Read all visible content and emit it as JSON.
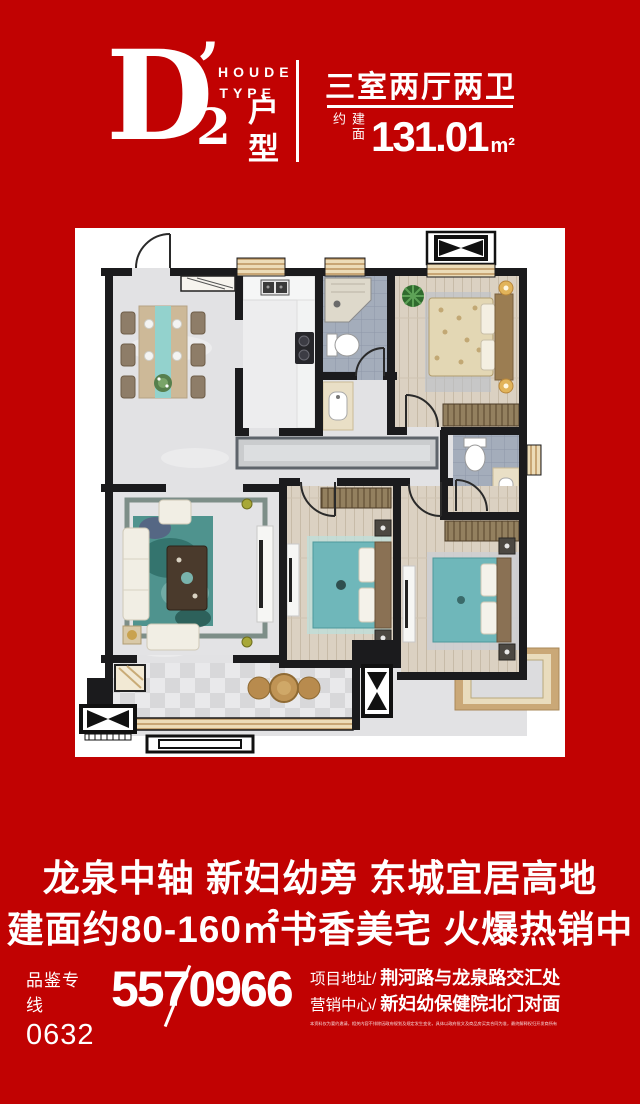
{
  "colors": {
    "background": "#c10202",
    "panel": "#ffffff",
    "text": "#ffffff",
    "wall": "#1b1b1d",
    "teal_furniture": "#6fb7ba",
    "wood_floor": "#dbd1c2",
    "tile_floor": "#a4adbb"
  },
  "header": {
    "type_letter": "D",
    "type_apostrophe": "’",
    "type_number": "2",
    "brand_line1": "HOUDE",
    "brand_line2": "TYPE",
    "type_label": "户型",
    "layout": "三室两厅两卫",
    "area_prefix": "建面约",
    "area_value": "131.01",
    "area_unit": "m²"
  },
  "marketing": {
    "line1": "龙泉中轴 新妇幼旁 东城宜居高地",
    "line2": "建面约80-160㎡书香美宅 火爆热销中"
  },
  "contact": {
    "hotline_label": "品鉴专线",
    "hotline_area_code": "0632",
    "hotline_number": "5570966",
    "address_label": "项目地址/",
    "address_value": "荆河路与龙泉路交汇处",
    "center_label": "营销中心/",
    "center_value": "新妇幼保健院北门对面",
    "disclaimer": "本资料仅为要约邀请，相关内容不排除因政府规划及规定发生变化，具体以政府批文及商品房买卖合同为准，最终解释权归开发商所有"
  }
}
